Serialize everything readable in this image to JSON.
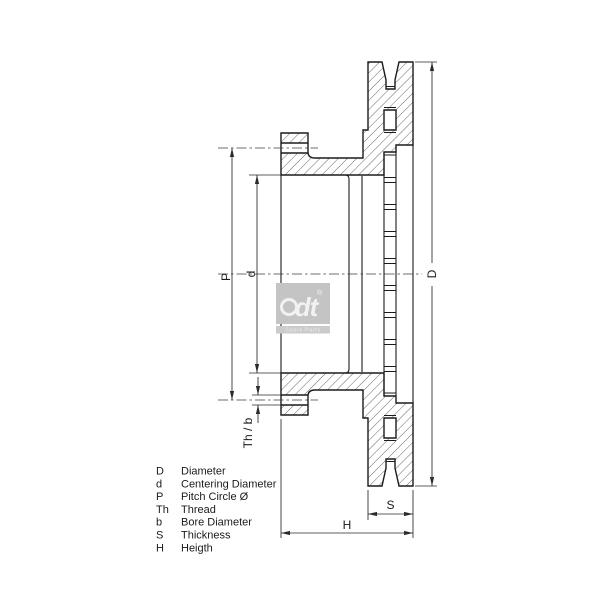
{
  "drawing": {
    "title": "brake disc cross-section",
    "dimension_labels": {
      "D": "D",
      "d": "d",
      "P": "P",
      "Th_b": "Th / b",
      "S": "S",
      "H": "H"
    },
    "watermark": {
      "logo": "dt",
      "registered": "®",
      "subtext": "Spare Parts"
    },
    "colors": {
      "outline": "#1b1b1b",
      "dimension": "#2b2b2b",
      "centerline": "#3c3c3c",
      "hatch": "#4d4d4d",
      "watermark_bg": "#c4c4c4",
      "watermark_band": "#cbcbcb",
      "watermark_fg": "#f2f2f2",
      "background": "#ffffff"
    }
  },
  "legend": {
    "items": [
      {
        "key": "D",
        "label": "Diameter"
      },
      {
        "key": "d",
        "label": "Centering Diameter"
      },
      {
        "key": "P",
        "label": "Pitch Circle Ø"
      },
      {
        "key": "Th",
        "label": "Thread"
      },
      {
        "key": "b",
        "label": "Bore Diameter"
      },
      {
        "key": "S",
        "label": "Thickness"
      },
      {
        "key": "H",
        "label": "Heigth"
      }
    ]
  }
}
